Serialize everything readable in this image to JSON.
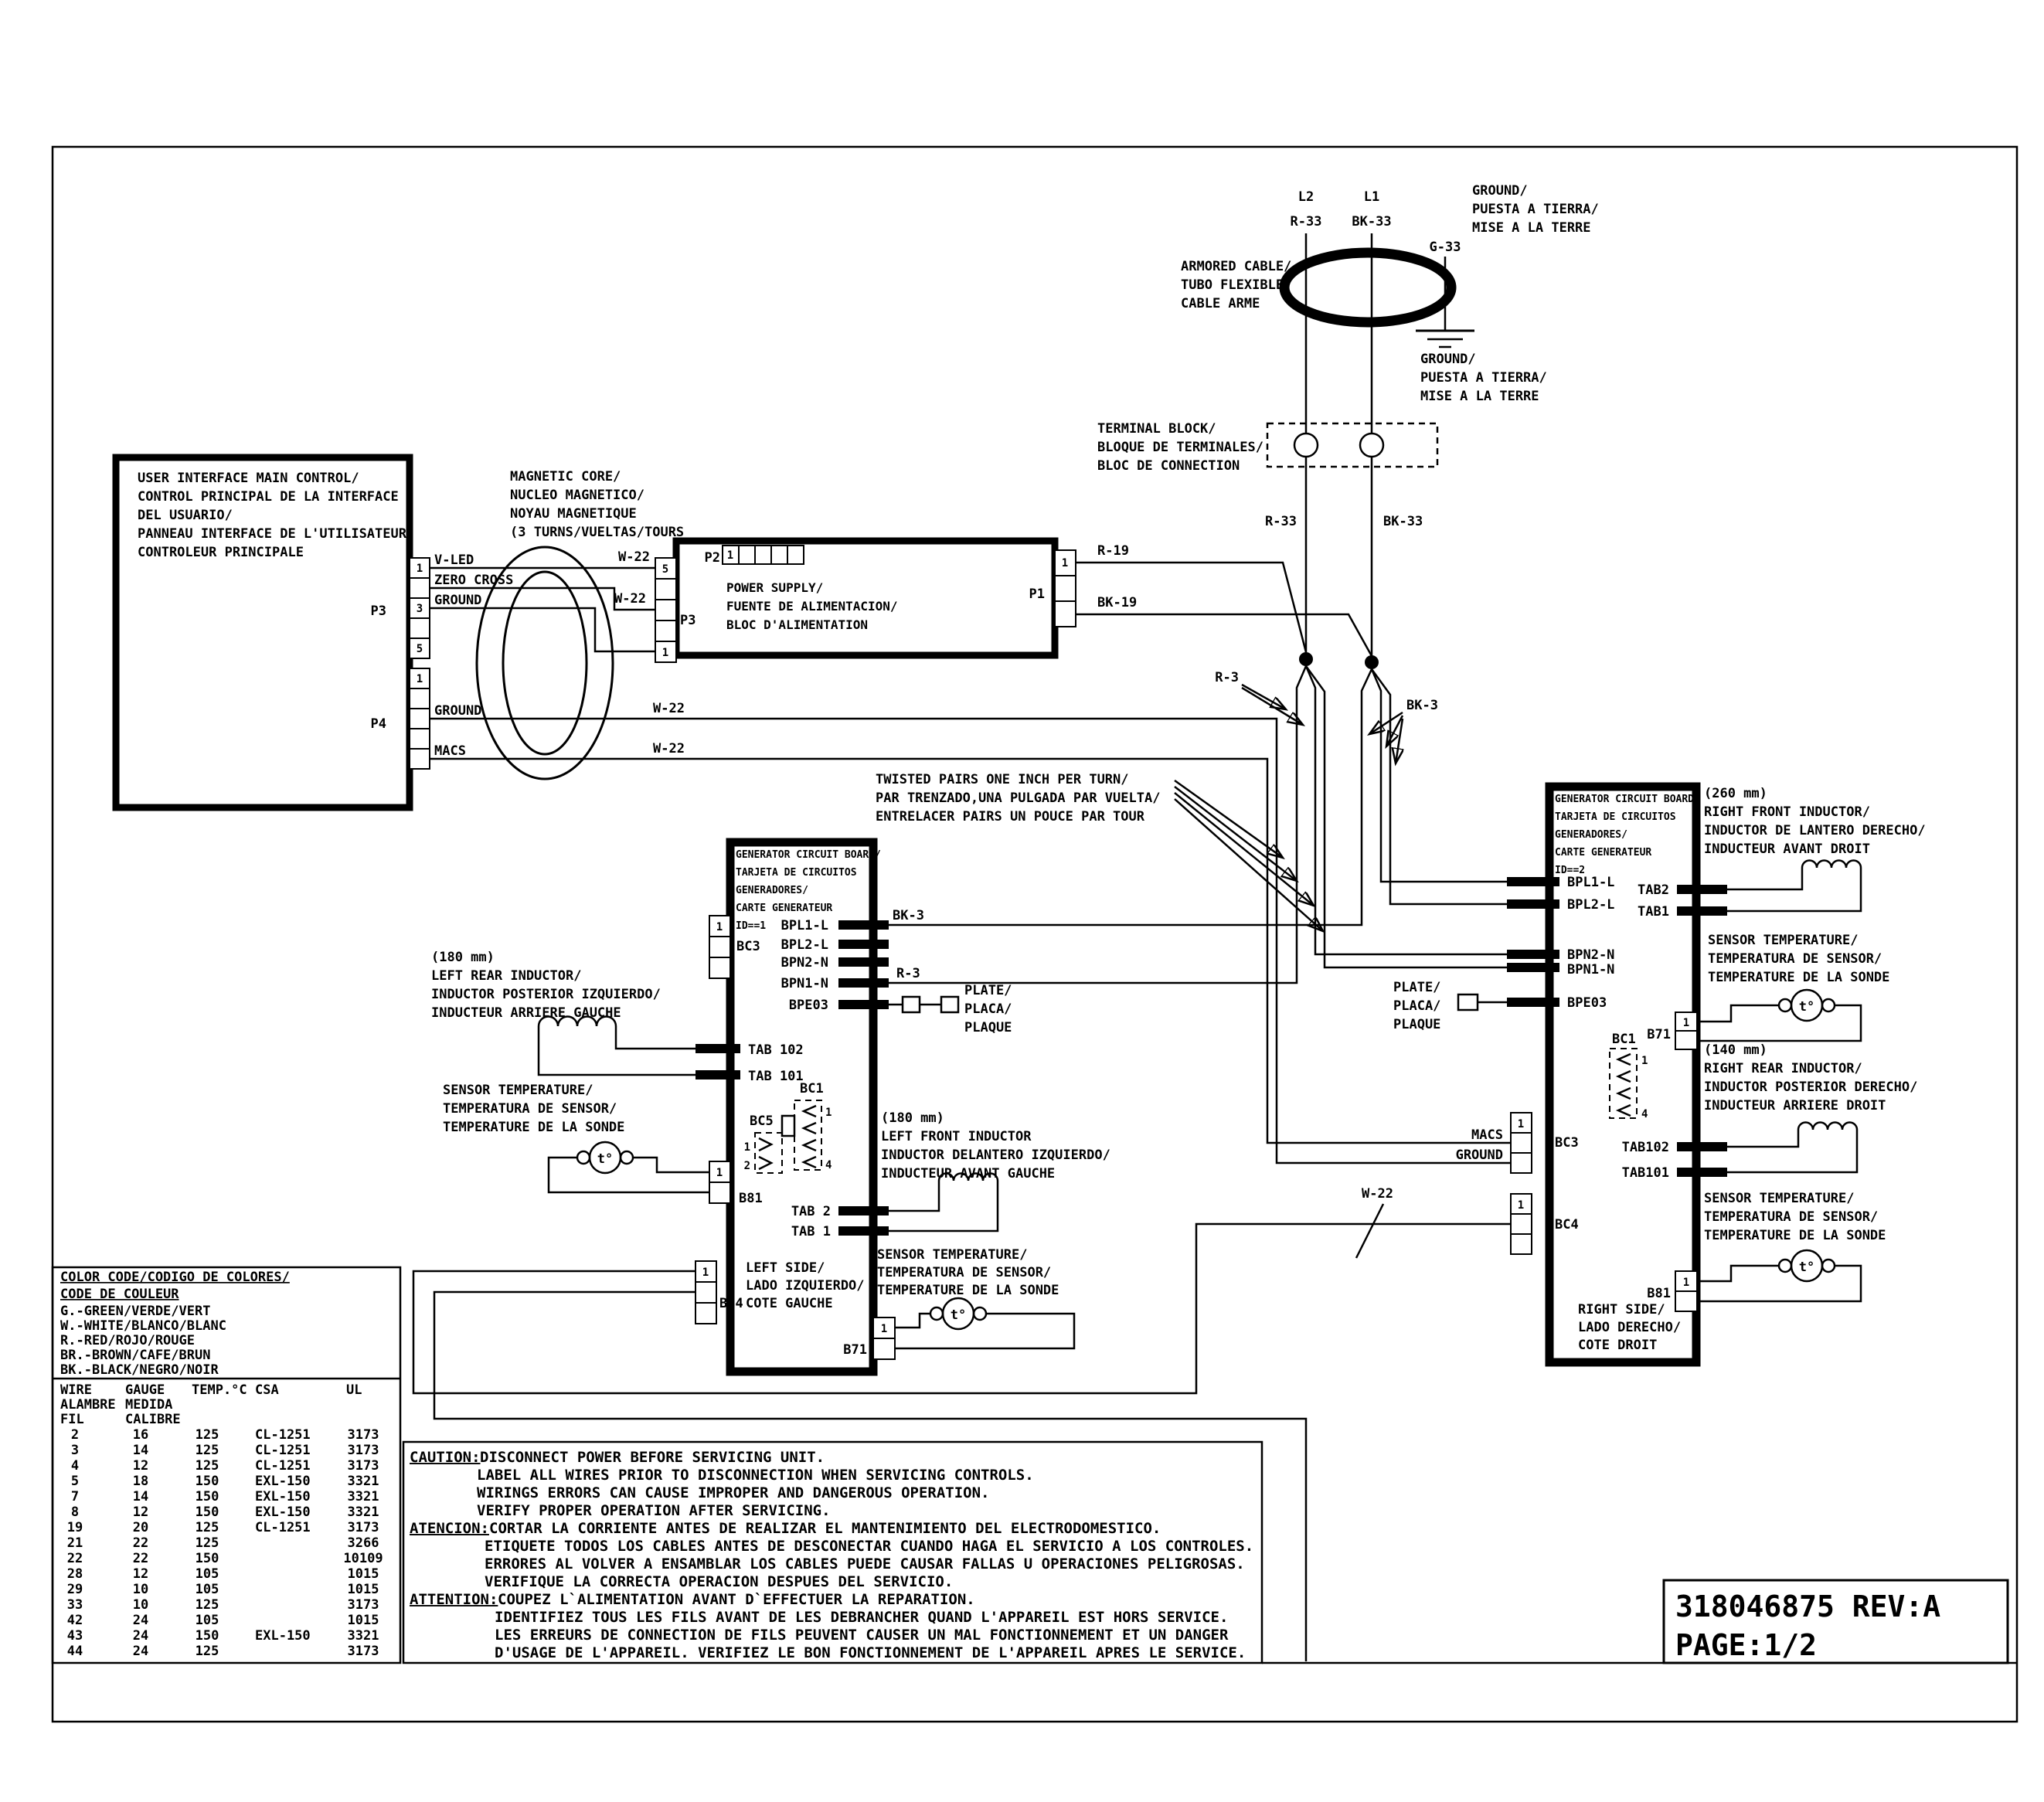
{
  "meta": {
    "part_number": "318046875 REV:A",
    "page": "PAGE:1/2"
  },
  "mains": {
    "l2": "L2",
    "l1": "L1",
    "r33": "R-33",
    "bk33": "BK-33",
    "g33": "G-33",
    "ground3": [
      "GROUND/",
      "PUESTA A TIERRA/",
      "MISE A LA TERRE"
    ],
    "armored": [
      "ARMORED CABLE/",
      "TUBO FLEXIBLE/",
      "CABLE ARME"
    ],
    "terminal": [
      "TERMINAL BLOCK/",
      "BLOQUE DE TERMINALES/",
      "BLOC DE CONNECTION"
    ],
    "r19": "R-19",
    "bk19": "BK-19",
    "r3": "R-3",
    "bk3": "BK-3"
  },
  "twisted": [
    "TWISTED PAIRS ONE INCH PER TURN/",
    "PAR TRENZADO,UNA PULGADA PAR VUELTA/",
    "ENTRELACER PAIRS UN POUCE PAR TOUR"
  ],
  "ui": {
    "title": [
      "USER INTERFACE MAIN CONTROL/",
      "CONTROL PRINCIPAL DE LA INTERFACE",
      "DEL USUARIO/",
      "PANNEAU INTERFACE DE L'UTILISATEUR",
      "CONTROLEUR PRINCIPALE"
    ],
    "p3": "P3",
    "p4": "P4",
    "v_led": "V-LED",
    "zero_cross": "ZERO CROSS",
    "ground": "GROUND",
    "macs": "MACS",
    "w22": "W-22"
  },
  "core_label": [
    "MAGNETIC CORE/",
    "NUCLEO MAGNETICO/",
    "NOYAU MAGNETIQUE",
    "(3 TURNS/VUELTAS/TOURS"
  ],
  "ps": {
    "title": [
      "POWER SUPPLY/",
      "FUENTE DE ALIMENTACION/",
      "BLOC D'ALIMENTATION"
    ],
    "p1": "P1",
    "p2": "P2",
    "p3": "P3"
  },
  "board1": {
    "title": [
      "GENERATOR CIRCUIT BOARD/",
      "TARJETA DE CIRCUITOS",
      "GENERADORES/",
      "CARTE GENERATEUR",
      "ID==1"
    ],
    "bpl1": "BPL1-L",
    "bpl2": "BPL2-L",
    "bpn2": "BPN2-N",
    "bpn1": "BPN1-N",
    "bpe03": "BPE03",
    "tab102": "TAB 102",
    "tab101": "TAB 101",
    "tab2": "TAB 2",
    "tab1": "TAB 1",
    "bc3": "BC3",
    "bc4": "BC4",
    "bc5": "BC5",
    "bc1": "BC1",
    "b81": "B81",
    "b71": "B71",
    "side": [
      "LEFT SIDE/",
      "LADO IZQUIERDO/",
      "COTE GAUCHE"
    ],
    "plate": [
      "PLATE/",
      "PLACA/",
      "PLAQUE"
    ],
    "rear_ind": [
      "(180 mm)",
      "LEFT REAR INDUCTOR/",
      "INDUCTOR POSTERIOR IZQUIERDO/",
      "INDUCTEUR ARRIERE GAUCHE"
    ],
    "front_ind": [
      "(180 mm)",
      "LEFT FRONT INDUCTOR",
      "INDUCTOR DELANTERO IZQUIERDO/",
      "INDUCTEUR AVANT GAUCHE"
    ],
    "sensor": [
      "SENSOR TEMPERATURE/",
      "TEMPERATURA DE SENSOR/",
      "TEMPERATURE DE LA SONDE"
    ]
  },
  "board2": {
    "title": [
      "GENERATOR CIRCUIT BOARD/",
      "TARJETA DE CIRCUITOS",
      "GENERADORES/",
      "CARTE GENERATEUR",
      "ID==2"
    ],
    "bpl1": "BPL1-L",
    "bpl2": "BPL2-L",
    "bpn2": "BPN2-N",
    "bpn1": "BPN1-N",
    "bpe03": "BPE03",
    "tab2": "TAB2",
    "tab1": "TAB1",
    "tab102": "TAB102",
    "tab101": "TAB101",
    "bc3": "BC3",
    "bc4": "BC4",
    "bc1": "BC1",
    "b71": "B71",
    "b81": "B81",
    "macs": "MACS",
    "ground": "GROUND",
    "side": [
      "RIGHT SIDE/",
      "LADO DERECHO/",
      "COTE DROIT"
    ],
    "plate": [
      "PLATE/",
      "PLACA/",
      "PLAQUE"
    ],
    "front_ind": [
      "(260 mm)",
      "RIGHT FRONT INDUCTOR/",
      "INDUCTOR DE LANTERO DERECHO/",
      "INDUCTEUR AVANT DROIT"
    ],
    "rear_ind": [
      "(140 mm)",
      "RIGHT REAR INDUCTOR/",
      "INDUCTOR POSTERIOR DERECHO/",
      "INDUCTEUR ARRIERE DROIT"
    ],
    "sensor": [
      "SENSOR TEMPERATURE/",
      "TEMPERATURA DE SENSOR/",
      "TEMPERATURE DE LA SONDE"
    ],
    "sensor2": [
      "SENSOR TEMPERATURE/",
      "TEMPERATURA DE SENSOR/",
      "TEMPERATURE DE LA SONDE"
    ]
  },
  "sensor_t": "t°",
  "digits": {
    "d1": "1",
    "d2": "2",
    "d3": "3",
    "d4": "4",
    "d5": "5"
  },
  "color_code": {
    "title1": "COLOR CODE/CODIGO DE COLORES/",
    "title2": "CODE DE COULEUR",
    "entries": [
      "G.-GREEN/VERDE/VERT",
      "W.-WHITE/BLANCO/BLANC",
      "R.-RED/ROJO/ROUGE",
      "BR.-BROWN/CAFE/BRUN",
      "BK.-BLACK/NEGRO/NOIR"
    ]
  },
  "wire_table": {
    "h_wire": "WIRE",
    "h_gauge": "GAUGE",
    "h_temp": "TEMP.°C",
    "h_csa": "CSA",
    "h_ul": "UL",
    "h_alambre": "ALAMBRE",
    "h_medida": "MEDIDA",
    "h_fil": "FIL",
    "h_calibre": "CALIBRE",
    "rows": [
      {
        "w": "2",
        "g": "16",
        "t": "125",
        "c": "CL-1251",
        "u": "3173"
      },
      {
        "w": "3",
        "g": "14",
        "t": "125",
        "c": "CL-1251",
        "u": "3173"
      },
      {
        "w": "4",
        "g": "12",
        "t": "125",
        "c": "CL-1251",
        "u": "3173"
      },
      {
        "w": "5",
        "g": "18",
        "t": "150",
        "c": "EXL-150",
        "u": "3321"
      },
      {
        "w": "7",
        "g": "14",
        "t": "150",
        "c": "EXL-150",
        "u": "3321"
      },
      {
        "w": "8",
        "g": "12",
        "t": "150",
        "c": "EXL-150",
        "u": "3321"
      },
      {
        "w": "19",
        "g": "20",
        "t": "125",
        "c": "CL-1251",
        "u": "3173"
      },
      {
        "w": "21",
        "g": "22",
        "t": "125",
        "c": "",
        "u": "3266"
      },
      {
        "w": "22",
        "g": "22",
        "t": "150",
        "c": "",
        "u": "10109"
      },
      {
        "w": "28",
        "g": "12",
        "t": "105",
        "c": "",
        "u": "1015"
      },
      {
        "w": "29",
        "g": "10",
        "t": "105",
        "c": "",
        "u": "1015"
      },
      {
        "w": "33",
        "g": "10",
        "t": "125",
        "c": "",
        "u": "3173"
      },
      {
        "w": "42",
        "g": "24",
        "t": "105",
        "c": "",
        "u": "1015"
      },
      {
        "w": "43",
        "g": "24",
        "t": "150",
        "c": "EXL-150",
        "u": "3321"
      },
      {
        "w": "44",
        "g": "24",
        "t": "125",
        "c": "",
        "u": "3173"
      }
    ]
  },
  "caution": {
    "h1": "CAUTION:",
    "l1": "DISCONNECT POWER BEFORE SERVICING UNIT.",
    "l2": "LABEL ALL WIRES PRIOR TO DISCONNECTION WHEN SERVICING CONTROLS.",
    "l3": "WIRINGS ERRORS CAN CAUSE IMPROPER AND DANGEROUS OPERATION.",
    "l4": "VERIFY PROPER OPERATION AFTER SERVICING.",
    "h2": "ATENCION:",
    "l5": "CORTAR LA CORRIENTE ANTES DE REALIZAR EL MANTENIMIENTO DEL ELECTRODOMESTICO.",
    "l6": "ETIQUETE TODOS LOS CABLES ANTES DE DESCONECTAR CUANDO HAGA EL SERVICIO A LOS CONTROLES.",
    "l7": "ERRORES AL VOLVER A ENSAMBLAR LOS CABLES PUEDE CAUSAR FALLAS U OPERACIONES PELIGROSAS.",
    "l8": "VERIFIQUE LA CORRECTA OPERACION DESPUES DEL SERVICIO.",
    "h3": "ATTENTION:",
    "l9": "COUPEZ L`ALIMENTATION AVANT D`EFFECTUER LA REPARATION.",
    "l10": "IDENTIFIEZ TOUS LES FILS AVANT DE LES DEBRANCHER QUAND L'APPAREIL EST HORS SERVICE.",
    "l11": "LES ERREURS DE CONNECTION DE FILS PEUVENT CAUSER UN MAL FONCTIONNEMENT ET UN DANGER",
    "l12": "D'USAGE DE L'APPAREIL. VERIFIEZ LE BON FONCTIONNEMENT DE L'APPAREIL APRES LE SERVICE."
  }
}
